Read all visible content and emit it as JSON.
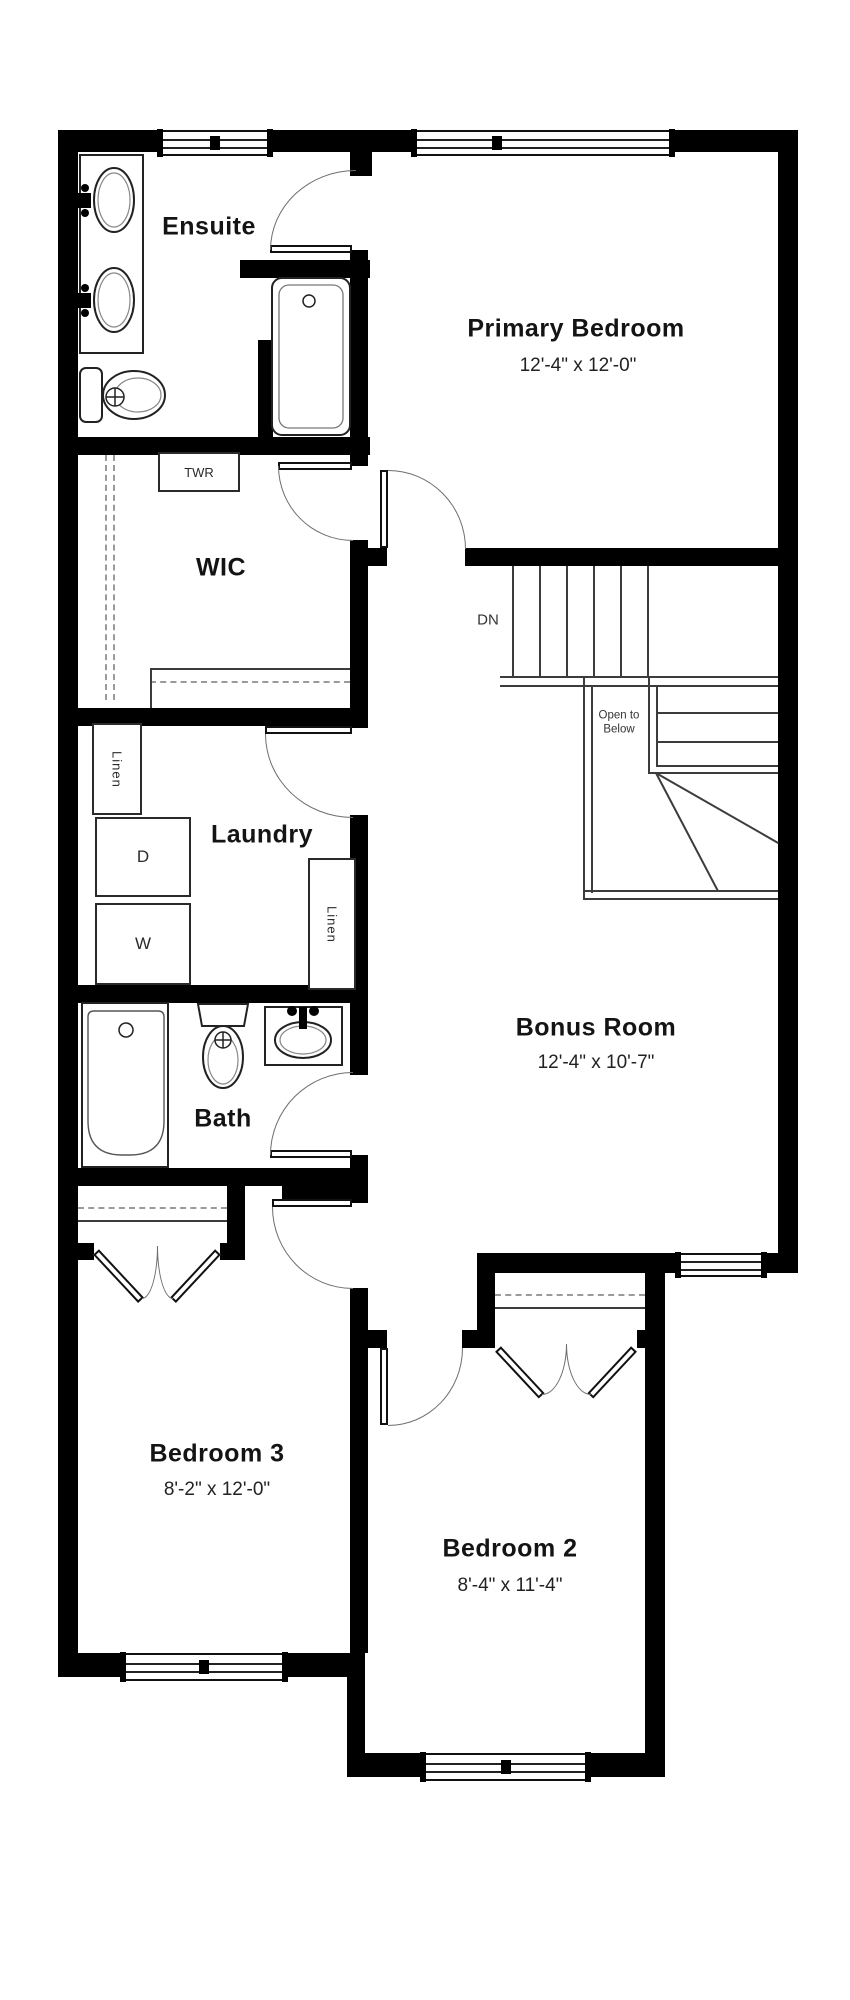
{
  "plan": {
    "rooms": {
      "ensuite": {
        "label": "Ensuite"
      },
      "primary_bedroom": {
        "label": "Primary Bedroom",
        "dims": "12'-4\" x 12'-0\""
      },
      "wic": {
        "label": "WIC"
      },
      "laundry": {
        "label": "Laundry"
      },
      "bath": {
        "label": "Bath"
      },
      "bonus_room": {
        "label": "Bonus Room",
        "dims": "12'-4\" x 10'-7\""
      },
      "bedroom3": {
        "label": "Bedroom 3",
        "dims": "8'-2\" x 12'-0\""
      },
      "bedroom2": {
        "label": "Bedroom 2",
        "dims": "8'-4\" x 11'-4\""
      }
    },
    "labels": {
      "twr": "TWR",
      "linen_upper": "Linen",
      "linen_lower": "Linen",
      "dryer": "D",
      "washer": "W",
      "down": "DN",
      "open_to_below": "Open to Below"
    },
    "colors": {
      "wall": "#000000",
      "line": "#3c3c3c",
      "text": "#141414",
      "background": "#ffffff"
    }
  }
}
